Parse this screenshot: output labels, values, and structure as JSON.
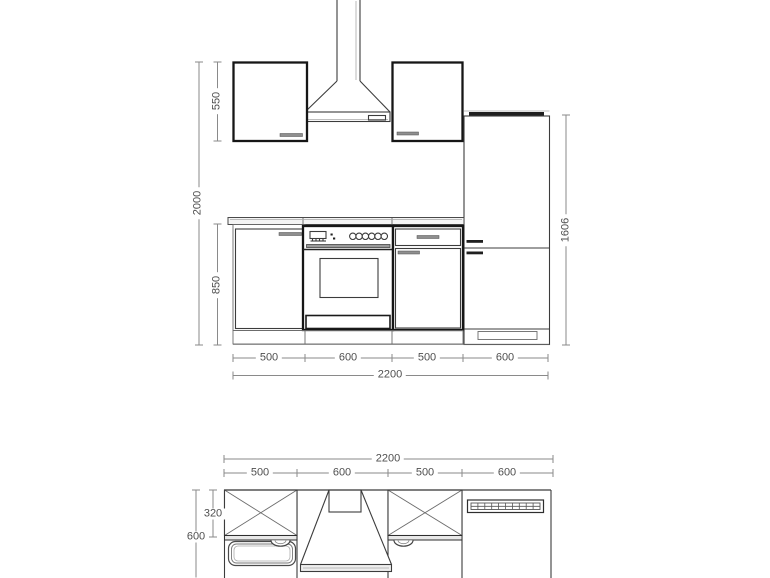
{
  "elevation": {
    "total_height": "2000",
    "wall_cabinet_height": "550",
    "base_unit_height": "850",
    "fridge_height": "1606",
    "width_segments": [
      "500",
      "600",
      "500",
      "600"
    ],
    "total_width": "2200"
  },
  "plan": {
    "total_width": "2200",
    "width_segments": [
      "500",
      "600",
      "500",
      "600"
    ],
    "wall_cabinet_depth": "320",
    "worktop_depth": "600"
  },
  "colors": {
    "outline_dark": "#161616",
    "outline_medium": "#3c3c3c",
    "dimension_line": "#8a8a8a",
    "dimension_text": "#4f4f4f",
    "background": "#ffffff"
  }
}
